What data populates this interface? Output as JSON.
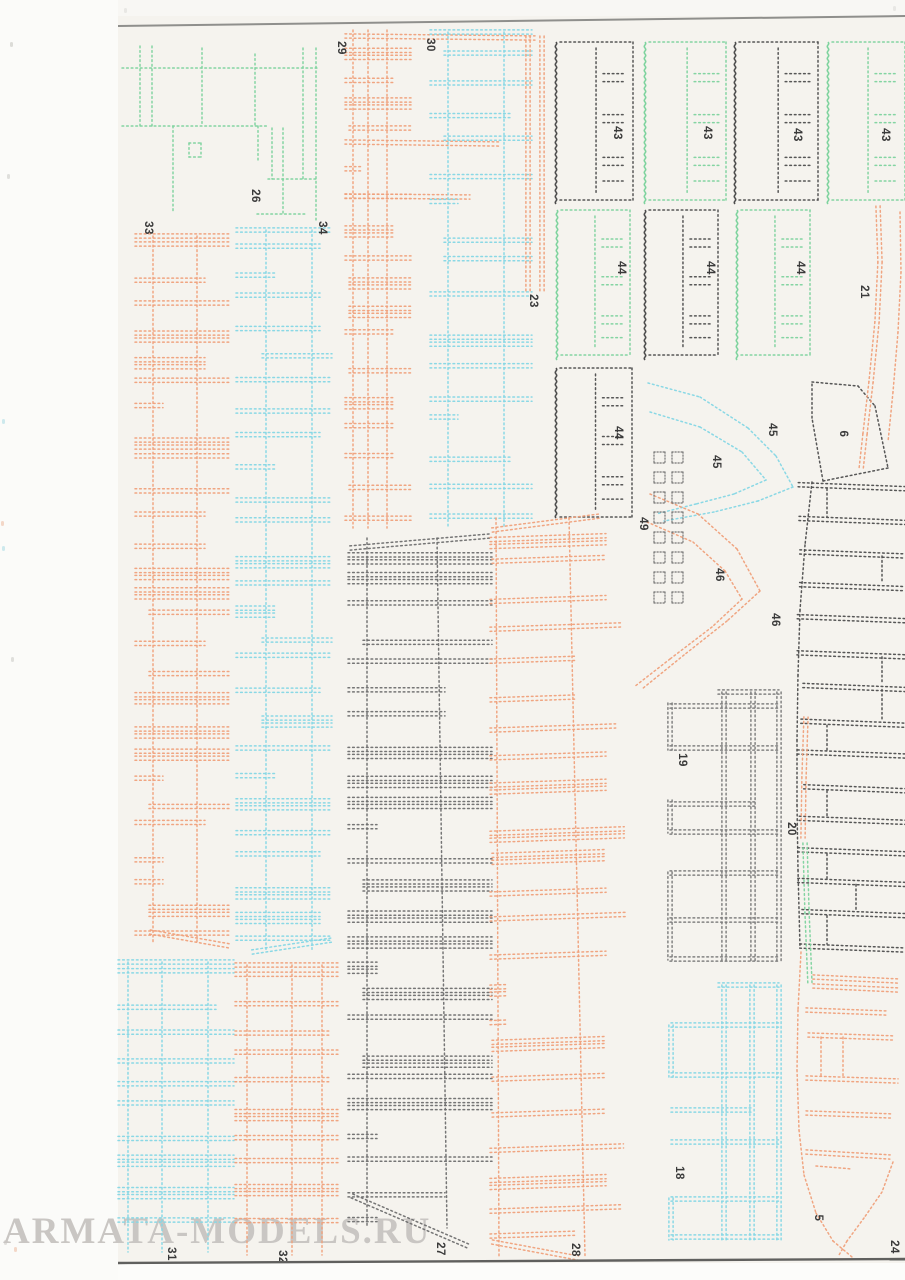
{
  "page": {
    "width": 905,
    "height": 1280,
    "scan_bg": "#fbfbf9",
    "paper_bg": "#f5f3ee",
    "paper_left": 118,
    "top_strip_bg": "#f8f7f4",
    "below_bg": "#fcfcfa",
    "top_edge": {
      "x1": 118,
      "y1": 26,
      "x2": 905,
      "y2": 16,
      "color": "#8f8f8c",
      "w": 2
    },
    "bottom_edge": {
      "x1": 118,
      "y1": 1263,
      "x2": 905,
      "y2": 1259,
      "color": "#60605e",
      "w": 2.4
    }
  },
  "watermark": {
    "text": "ARMATA-MODELS.RU",
    "x": 3,
    "y": 1250,
    "size": 37,
    "color": "#c9c6c3"
  },
  "colors": {
    "orange": "#f0a17c",
    "cyan": "#85d7e5",
    "green": "#7ed39e",
    "dark": "#4e4e4e",
    "gray27": "#6f6f6f",
    "gray19": "#7c7c7c",
    "label": "#3a3a3a"
  },
  "labels": [
    {
      "t": "33",
      "x": 148,
      "y": 228
    },
    {
      "t": "26",
      "x": 255,
      "y": 196
    },
    {
      "t": "34",
      "x": 322,
      "y": 228
    },
    {
      "t": "29",
      "x": 341,
      "y": 48
    },
    {
      "t": "30",
      "x": 430,
      "y": 45
    },
    {
      "t": "23",
      "x": 533,
      "y": 301
    },
    {
      "t": "43",
      "x": 617,
      "y": 133
    },
    {
      "t": "43",
      "x": 707,
      "y": 133
    },
    {
      "t": "43",
      "x": 797,
      "y": 135
    },
    {
      "t": "43",
      "x": 885,
      "y": 135
    },
    {
      "t": "44",
      "x": 621,
      "y": 268
    },
    {
      "t": "44",
      "x": 710,
      "y": 268
    },
    {
      "t": "44",
      "x": 800,
      "y": 268
    },
    {
      "t": "44",
      "x": 618,
      "y": 433
    },
    {
      "t": "45",
      "x": 716,
      "y": 462
    },
    {
      "t": "45",
      "x": 772,
      "y": 430
    },
    {
      "t": "49",
      "x": 643,
      "y": 524
    },
    {
      "t": "46",
      "x": 719,
      "y": 575
    },
    {
      "t": "46",
      "x": 775,
      "y": 620
    },
    {
      "t": "6",
      "x": 843,
      "y": 434
    },
    {
      "t": "21",
      "x": 864,
      "y": 292
    },
    {
      "t": "19",
      "x": 682,
      "y": 760
    },
    {
      "t": "20",
      "x": 791,
      "y": 829
    },
    {
      "t": "18",
      "x": 679,
      "y": 1173
    },
    {
      "t": "5",
      "x": 818,
      "y": 1218
    },
    {
      "t": "27",
      "x": 440,
      "y": 1249
    },
    {
      "t": "28",
      "x": 575,
      "y": 1250
    },
    {
      "t": "31",
      "x": 171,
      "y": 1254
    },
    {
      "t": "32",
      "x": 282,
      "y": 1257
    },
    {
      "t": "24",
      "x": 894,
      "y": 1247
    }
  ],
  "specks": [
    {
      "x": 10,
      "y": 42,
      "c": "#bdbdb8"
    },
    {
      "x": 7,
      "y": 174,
      "c": "#c4c4bf"
    },
    {
      "x": 11,
      "y": 657,
      "c": "#c4c4bf"
    },
    {
      "x": 4,
      "y": 1240,
      "c": "#c6c2be"
    },
    {
      "x": 2,
      "y": 419,
      "c": "#9fd8e2"
    },
    {
      "x": 2,
      "y": 546,
      "c": "#9fd8e2"
    },
    {
      "x": 1,
      "y": 521,
      "c": "#ecb395"
    },
    {
      "x": 14,
      "y": 1247,
      "c": "#ecb395"
    },
    {
      "x": 124,
      "y": 8,
      "c": "#d8d8d4"
    },
    {
      "x": 893,
      "y": 6,
      "c": "#d8d8d4"
    }
  ],
  "parts": [
    {
      "id": "26",
      "type": "segs",
      "color": "green",
      "s": [
        [
          122,
          68,
          318,
          68,
          0
        ],
        [
          122,
          126,
          268,
          126,
          0
        ],
        [
          268,
          179,
          318,
          179,
          0
        ],
        [
          257,
          214,
          306,
          214,
          0
        ],
        [
          140,
          46,
          140,
          126,
          0
        ],
        [
          152,
          46,
          152,
          126,
          0
        ],
        [
          202,
          48,
          202,
          126,
          0
        ],
        [
          255,
          54,
          255,
          126,
          0
        ],
        [
          173,
          126,
          173,
          212,
          0
        ],
        [
          272,
          128,
          272,
          179,
          0
        ],
        [
          283,
          128,
          283,
          179,
          0
        ],
        [
          303,
          48,
          303,
          179,
          0
        ],
        [
          316,
          48,
          316,
          220,
          0
        ],
        [
          283,
          179,
          283,
          214,
          0
        ],
        [
          258,
          126,
          258,
          160,
          0
        ],
        [
          189,
          143,
          201,
          143,
          0
        ],
        [
          189,
          157,
          201,
          157,
          0
        ],
        [
          189,
          143,
          189,
          157,
          0
        ],
        [
          201,
          143,
          201,
          157,
          0
        ]
      ]
    },
    {
      "id": "33",
      "type": "ladder",
      "x": 137,
      "y": 236,
      "w": 90,
      "h": 708,
      "rails": [
        16,
        60
      ],
      "n": 27,
      "seed": 7,
      "color": "orange",
      "capT": 1,
      "taperB": [
        150,
        932,
        230,
        946
      ]
    },
    {
      "id": "34",
      "type": "ladder",
      "x": 238,
      "y": 230,
      "w": 92,
      "h": 722,
      "rails": [
        28,
        74
      ],
      "n": 26,
      "seed": 11,
      "color": "cyan",
      "capT": 1,
      "taperB": [
        252,
        952,
        332,
        940
      ]
    },
    {
      "id": "29",
      "type": "ladder",
      "x": 347,
      "y": 30,
      "w": 62,
      "h": 498,
      "rails": [
        6,
        21,
        40
      ],
      "n": 17,
      "seed": 3,
      "color": "orange",
      "extR": 55
    },
    {
      "id": "29x",
      "type": "segs",
      "color": "orange",
      "s": [
        [
          345,
          36,
          535,
          38,
          1
        ],
        [
          345,
          142,
          500,
          144,
          1
        ],
        [
          345,
          196,
          470,
          197,
          1
        ]
      ]
    },
    {
      "id": "30",
      "type": "ladder",
      "x": 432,
      "y": 32,
      "w": 98,
      "h": 496,
      "rails": [
        16,
        72
      ],
      "n": 16,
      "seed": 5,
      "color": "cyan",
      "capT": 1
    },
    {
      "id": "23",
      "type": "arcs",
      "color": "orange",
      "dbl": 1,
      "lines": [
        [
          [
            528,
            36
          ],
          [
            528,
            292
          ]
        ],
        [
          [
            542,
            36
          ],
          [
            542,
            292
          ]
        ]
      ]
    },
    {
      "id": "43a",
      "type": "rect",
      "x": 556,
      "y": 42,
      "w": 77,
      "h": 158,
      "edge": "dark"
    },
    {
      "id": "43b",
      "type": "rect",
      "x": 645,
      "y": 42,
      "w": 81,
      "h": 158,
      "edge": "green"
    },
    {
      "id": "43c",
      "type": "rect",
      "x": 735,
      "y": 42,
      "w": 83,
      "h": 158,
      "edge": "dark"
    },
    {
      "id": "43d",
      "type": "rect",
      "x": 828,
      "y": 42,
      "w": 77,
      "h": 158,
      "edge": "green"
    },
    {
      "id": "44a",
      "type": "rect",
      "x": 557,
      "y": 210,
      "w": 73,
      "h": 145,
      "edge": "green"
    },
    {
      "id": "44b",
      "type": "rect",
      "x": 645,
      "y": 210,
      "w": 73,
      "h": 145,
      "edge": "dark"
    },
    {
      "id": "44c",
      "type": "rect",
      "x": 737,
      "y": 210,
      "w": 73,
      "h": 145,
      "edge": "green"
    },
    {
      "id": "44d",
      "type": "rect",
      "x": 556,
      "y": 368,
      "w": 76,
      "h": 149,
      "edge": "dark"
    },
    {
      "id": "45",
      "type": "arcs",
      "color": "cyan",
      "dbl": 0,
      "lines": [
        [
          [
            648,
            383
          ],
          [
            700,
            397
          ],
          [
            748,
            428
          ],
          [
            776,
            456
          ],
          [
            793,
            487
          ]
        ],
        [
          [
            793,
            487
          ],
          [
            758,
            501
          ],
          [
            714,
            512
          ],
          [
            664,
            521
          ]
        ],
        [
          [
            650,
            412
          ],
          [
            700,
            427
          ],
          [
            742,
            452
          ],
          [
            766,
            480
          ]
        ],
        [
          [
            766,
            480
          ],
          [
            734,
            494
          ],
          [
            696,
            504
          ],
          [
            656,
            514
          ]
        ]
      ]
    },
    {
      "id": "46",
      "type": "arcs",
      "color": "orange",
      "dbl": 0,
      "lines": [
        [
          [
            650,
            494
          ],
          [
            698,
            514
          ],
          [
            737,
            549
          ],
          [
            760,
            591
          ]
        ],
        [
          [
            760,
            591
          ],
          [
            727,
            621
          ],
          [
            684,
            655
          ],
          [
            642,
            689
          ]
        ],
        [
          [
            647,
            522
          ],
          [
            693,
            542
          ],
          [
            725,
            571
          ],
          [
            742,
            599
          ]
        ],
        [
          [
            742,
            599
          ],
          [
            712,
            627
          ],
          [
            670,
            659
          ],
          [
            634,
            687
          ]
        ]
      ]
    },
    {
      "id": "49",
      "type": "sq",
      "x": 654,
      "y": 452,
      "rows": 8,
      "cols": 2,
      "cell": 11,
      "gx": 7,
      "gy": 9,
      "color": "gray27"
    },
    {
      "id": "6",
      "type": "poly",
      "color": "dark",
      "pts": [
        [
          812,
          382
        ],
        [
          858,
          386
        ],
        [
          875,
          406
        ],
        [
          888,
          468
        ],
        [
          823,
          481
        ],
        [
          812,
          418
        ]
      ]
    },
    {
      "id": "deck",
      "type": "bars",
      "x0": 797,
      "x1": 905,
      "y0": 487,
      "y1": 948,
      "n": 15,
      "seed": 29,
      "color": "dark",
      "verts": [
        827,
        856,
        882
      ],
      "rail": [
        [
          812,
          482
        ],
        [
          805,
          545
        ],
        [
          800,
          610
        ],
        [
          798,
          675
        ],
        [
          797,
          740
        ],
        [
          797,
          805
        ],
        [
          798,
          870
        ],
        [
          800,
          948
        ]
      ]
    },
    {
      "id": "19",
      "type": "grid",
      "color": "gray19",
      "v": [
        [
          670,
          703,
          750
        ],
        [
          670,
          800,
          833
        ],
        [
          670,
          872,
          960
        ],
        [
          724,
          692,
          962
        ],
        [
          753,
          692,
          962
        ],
        [
          779,
          692,
          962
        ]
      ],
      "hl": [
        [
          692,
          718,
          779
        ],
        [
          706,
          670,
          779
        ],
        [
          748,
          670,
          779
        ],
        [
          804,
          670,
          757
        ],
        [
          832,
          670,
          779
        ],
        [
          873,
          670,
          779
        ],
        [
          920,
          670,
          779
        ],
        [
          959,
          670,
          779
        ]
      ]
    },
    {
      "id": "18",
      "type": "grid",
      "color": "cyan",
      "v": [
        [
          671,
          1025,
          1077
        ],
        [
          671,
          1198,
          1240
        ],
        [
          724,
          985,
          1240
        ],
        [
          752,
          985,
          1240
        ],
        [
          779,
          985,
          1240
        ]
      ],
      "hl": [
        [
          985,
          718,
          779
        ],
        [
          1025,
          671,
          779
        ],
        [
          1075,
          671,
          779
        ],
        [
          1110,
          671,
          752
        ],
        [
          1142,
          671,
          779
        ],
        [
          1199,
          671,
          779
        ],
        [
          1237,
          671,
          779
        ]
      ]
    },
    {
      "id": "20",
      "type": "arcs",
      "color": "orange",
      "dbl": 1,
      "lines": [
        [
          [
            806,
            717
          ],
          [
            804,
            777
          ],
          [
            803,
            838
          ]
        ]
      ]
    },
    {
      "id": "20g",
      "type": "arcs",
      "color": "green",
      "dbl": 1,
      "lines": [
        [
          [
            805,
            843
          ],
          [
            807,
            912
          ],
          [
            810,
            985
          ]
        ]
      ]
    },
    {
      "id": "21",
      "type": "arcs",
      "color": "orange",
      "dbl": 1,
      "lines": [
        [
          [
            878,
            206
          ],
          [
            880,
            262
          ],
          [
            877,
            322
          ],
          [
            871,
            382
          ],
          [
            865,
            434
          ],
          [
            861,
            470
          ]
        ]
      ]
    },
    {
      "id": "21b",
      "type": "arcs",
      "color": "orange",
      "dbl": 0,
      "lines": [
        [
          [
            900,
            212
          ],
          [
            901,
            272
          ],
          [
            898,
            332
          ],
          [
            893,
            392
          ],
          [
            888,
            442
          ]
        ]
      ]
    },
    {
      "id": "27",
      "type": "ladder",
      "x": 350,
      "y": 538,
      "w": 140,
      "h": 690,
      "rails": [
        17,
        87
      ],
      "n": 25,
      "seed": 13,
      "color": "gray27",
      "railSlant": [
        0,
        10
      ],
      "capSlant": [
        350,
        548,
        490,
        536
      ],
      "taperB": [
        352,
        1196,
        468,
        1246
      ]
    },
    {
      "id": "28",
      "type": "ladder",
      "x": 492,
      "y": 518,
      "w": 112,
      "h": 738,
      "rails": [
        4,
        77
      ],
      "n": 23,
      "seed": 17,
      "color": "orange",
      "slant": -5,
      "extR": 22,
      "railSlant": [
        3,
        16
      ],
      "capSlant": [
        492,
        530,
        600,
        516
      ],
      "taperB": [
        492,
        1242,
        578,
        1258
      ]
    },
    {
      "id": "31",
      "type": "ladder",
      "x": 120,
      "y": 962,
      "w": 112,
      "h": 290,
      "rails": [
        8,
        42,
        88
      ],
      "n": 11,
      "seed": 19,
      "color": "cyan",
      "full": 0.85,
      "capT": 1
    },
    {
      "id": "32",
      "type": "ladder",
      "x": 237,
      "y": 965,
      "w": 100,
      "h": 290,
      "rails": [
        10,
        55,
        85
      ],
      "n": 11,
      "seed": 23,
      "color": "orange",
      "full": 0.85,
      "capT": 1
    },
    {
      "id": "5s",
      "type": "segs",
      "color": "orange",
      "s": [
        [
          813,
          977,
          898,
          981,
          1
        ],
        [
          813,
          986,
          898,
          990,
          1
        ],
        [
          806,
          1010,
          886,
          1013,
          1
        ],
        [
          808,
          1035,
          895,
          1038,
          1
        ],
        [
          806,
          1078,
          898,
          1081,
          1
        ],
        [
          806,
          1113,
          893,
          1116,
          1
        ],
        [
          806,
          1152,
          890,
          1157,
          1
        ],
        [
          821,
          1037,
          821,
          1078,
          0
        ],
        [
          843,
          1037,
          843,
          1078,
          0
        ],
        [
          816,
          1166,
          852,
          1169,
          0
        ]
      ]
    },
    {
      "id": "5r",
      "type": "arcs",
      "color": "orange",
      "dbl": 0,
      "lines": [
        [
          [
            801,
            952
          ],
          [
            798,
            1010
          ],
          [
            797,
            1070
          ],
          [
            799,
            1130
          ],
          [
            804,
            1175
          ],
          [
            816,
            1213
          ],
          [
            833,
            1241
          ],
          [
            852,
            1257
          ]
        ],
        [
          [
            893,
            1162
          ],
          [
            882,
            1192
          ],
          [
            864,
            1218
          ],
          [
            847,
            1241
          ],
          [
            839,
            1255
          ]
        ]
      ]
    }
  ]
}
